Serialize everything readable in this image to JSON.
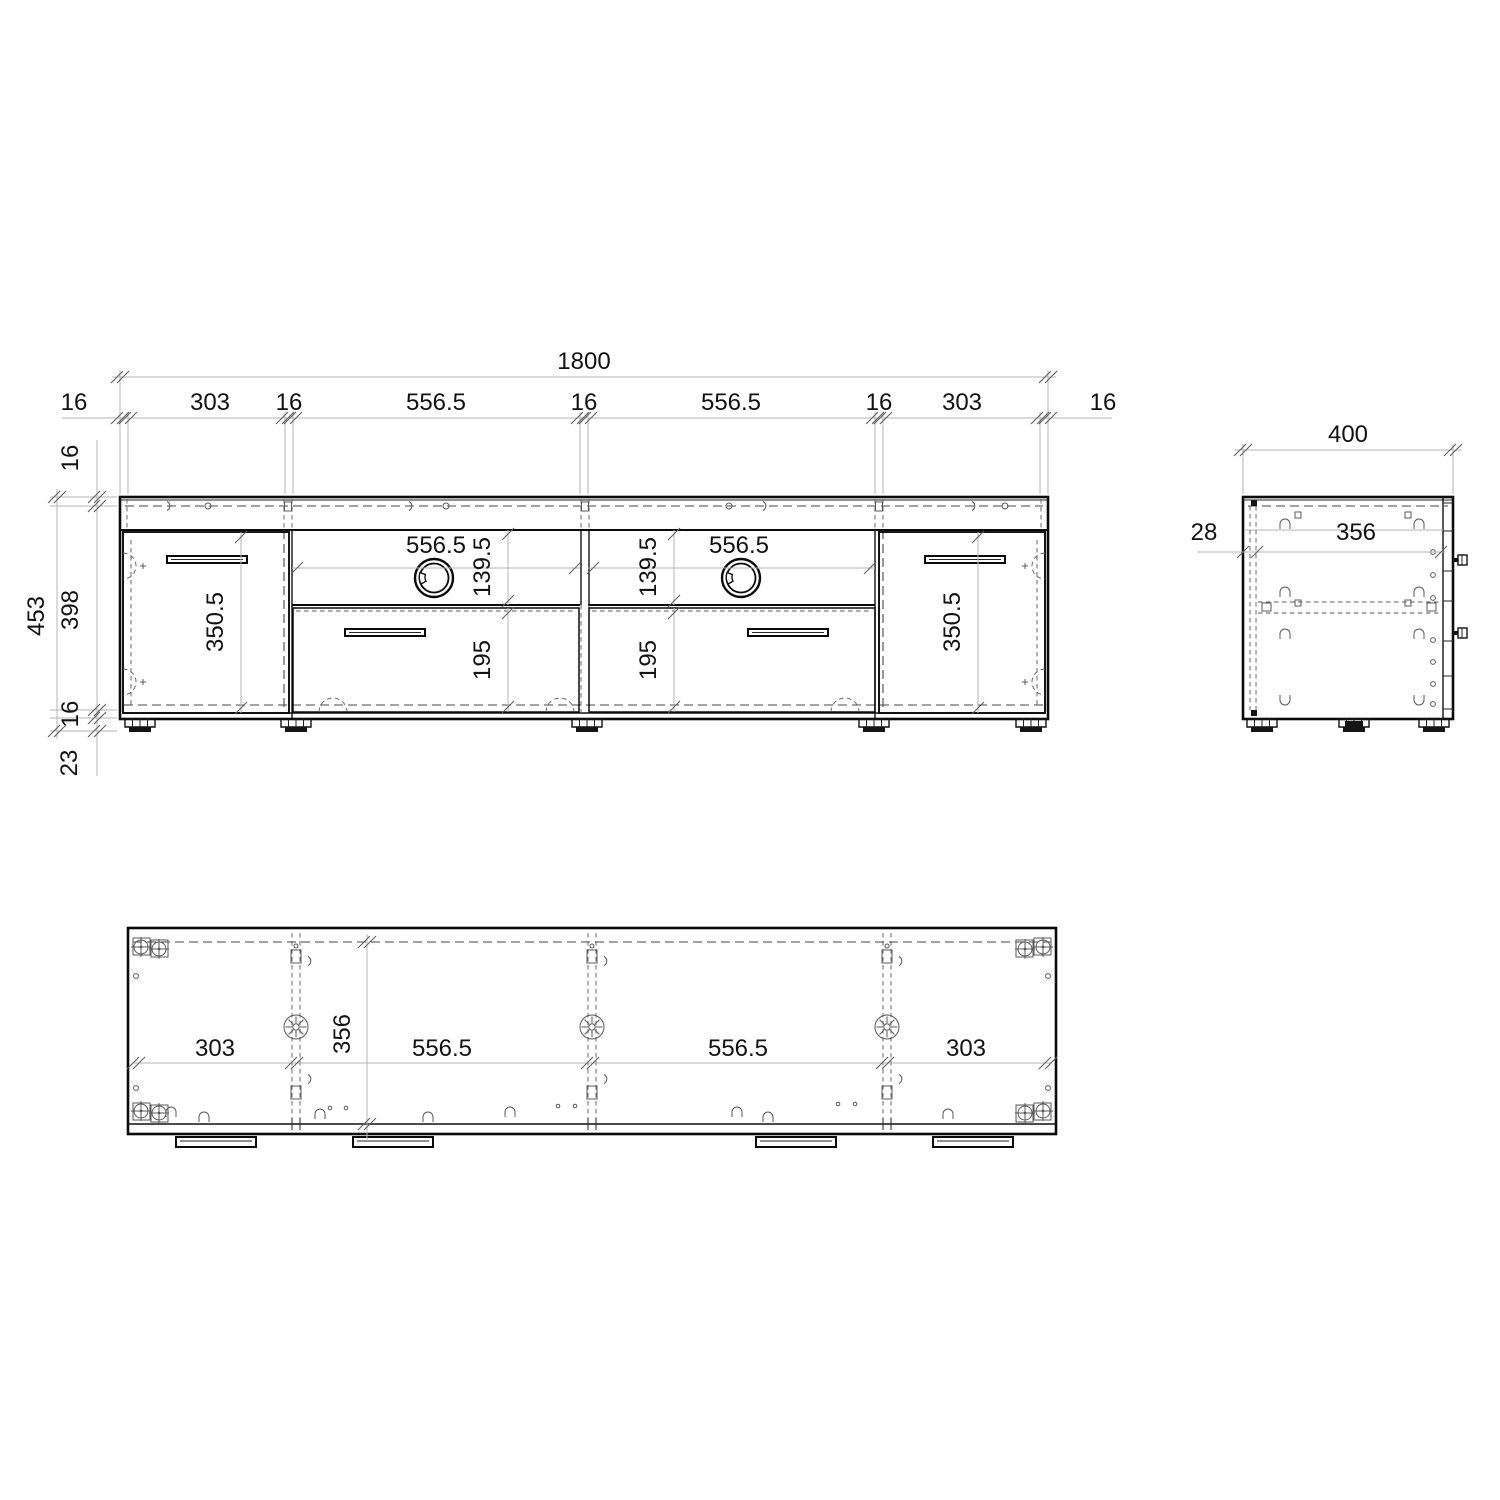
{
  "colors": {
    "background": "#ffffff",
    "object_line": "#0a0a0a",
    "hidden_line": "#474747",
    "dimension_line": "#b4b4b4",
    "text": "#121212"
  },
  "front_view": {
    "total_width": "1800",
    "width_chain": [
      "16",
      "303",
      "16",
      "556.5",
      "16",
      "556.5",
      "16",
      "303",
      "16"
    ],
    "total_height": "453",
    "height_chain": [
      "16",
      "398",
      "16",
      "23"
    ],
    "openings": {
      "left": {
        "width": "556.5",
        "height": "139.5"
      },
      "right": {
        "width": "556.5",
        "height": "139.5"
      }
    },
    "doors": {
      "left_height": "350.5",
      "right_height": "350.5"
    },
    "drawers": {
      "left_height": "195",
      "right_height": "195"
    }
  },
  "side_view": {
    "depth": "400",
    "front_offset": "28",
    "inner_depth": "356"
  },
  "top_view": {
    "width_chain": [
      "303",
      "556.5",
      "556.5",
      "303"
    ],
    "inner_depth": "356"
  }
}
